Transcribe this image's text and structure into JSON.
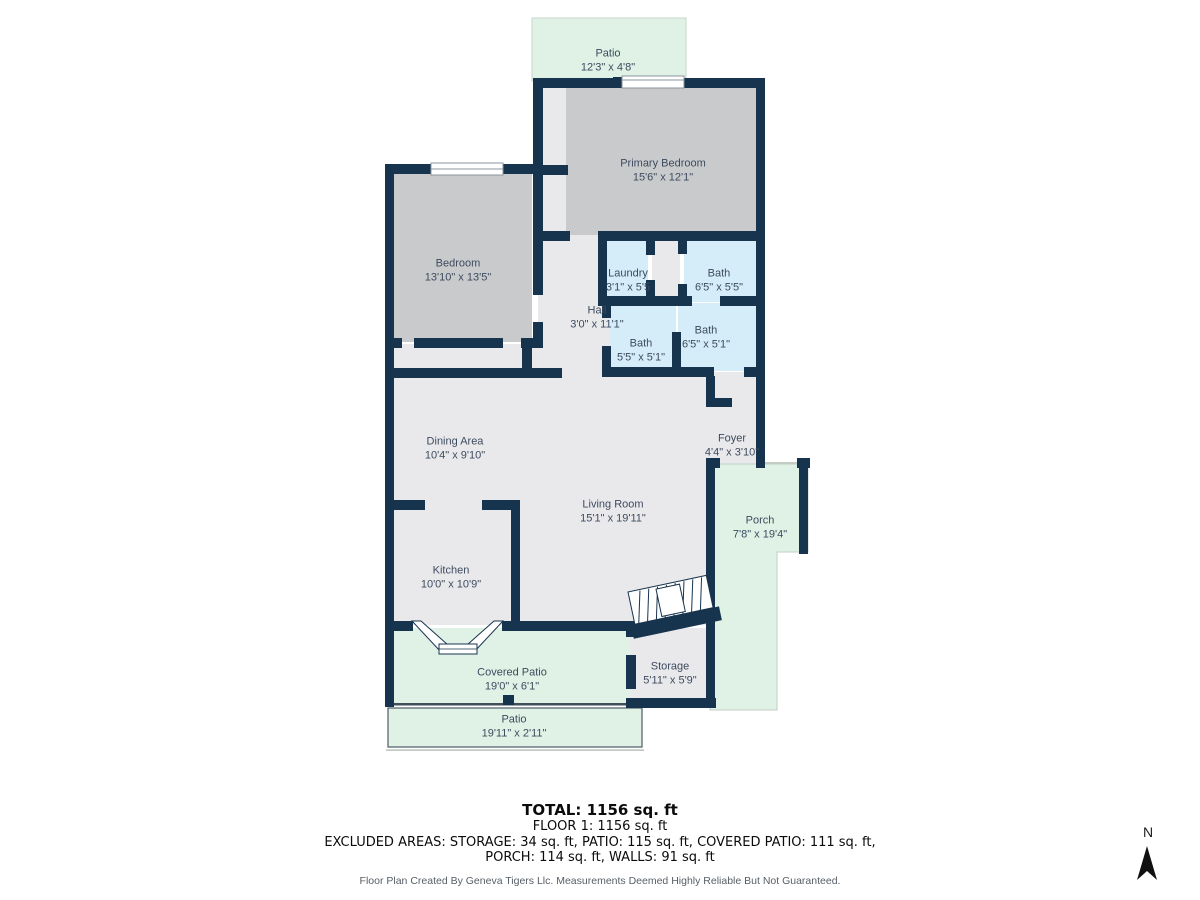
{
  "plan": {
    "rooms": [
      {
        "id": "patio-top",
        "name": "Patio",
        "dims": "12'3\" x 4'8\""
      },
      {
        "id": "primary-bedroom",
        "name": "Primary Bedroom",
        "dims": "15'6\" x 12'1\""
      },
      {
        "id": "bedroom",
        "name": "Bedroom",
        "dims": "13'10\" x 13'5\""
      },
      {
        "id": "laundry",
        "name": "Laundry",
        "dims": "3'1\" x 5'5"
      },
      {
        "id": "bath-top",
        "name": "Bath",
        "dims": "6'5\" x 5'5\""
      },
      {
        "id": "hall",
        "name": "Hall",
        "dims": "3'0\" x 11'1\""
      },
      {
        "id": "bath-left",
        "name": "Bath",
        "dims": "5'5\" x 5'1\""
      },
      {
        "id": "bath-right",
        "name": "Bath",
        "dims": "6'5\" x 5'1\""
      },
      {
        "id": "dining-area",
        "name": "Dining Area",
        "dims": "10'4\" x 9'10\""
      },
      {
        "id": "foyer",
        "name": "Foyer",
        "dims": "4'4\" x 3'10\""
      },
      {
        "id": "living-room",
        "name": "Living Room",
        "dims": "15'1\" x 19'11\""
      },
      {
        "id": "porch",
        "name": "Porch",
        "dims": "7'8\" x 19'4\""
      },
      {
        "id": "kitchen",
        "name": "Kitchen",
        "dims": "10'0\" x 10'9\""
      },
      {
        "id": "covered-patio",
        "name": "Covered Patio",
        "dims": "19'0\" x 6'1\""
      },
      {
        "id": "storage",
        "name": "Storage",
        "dims": "5'11\" x 5'9\""
      },
      {
        "id": "patio-bottom",
        "name": "Patio",
        "dims": "19'11\" x 2'11\""
      }
    ],
    "summary": {
      "total": "TOTAL: 1156 sq. ft",
      "floor": "FLOOR 1: 1156 sq. ft",
      "excluded_line1": "EXCLUDED AREAS: STORAGE: 34 sq. ft, PATIO: 115 sq. ft, COVERED PATIO: 111 sq. ft,",
      "excluded_line2": "PORCH: 114 sq. ft, WALLS: 91 sq. ft"
    },
    "disclaimer": "Floor Plan Created By Geneva Tigers Llc. Measurements Deemed Highly Reliable But Not Guaranteed.",
    "compass": {
      "label": "N"
    },
    "colors": {
      "wall": "#17344E",
      "bedroom_fill": "#C9CACC",
      "floor_fill": "#E9E9EB",
      "bath_fill": "#D5ECF9",
      "outdoor_fill": "#DFF2E5"
    }
  }
}
